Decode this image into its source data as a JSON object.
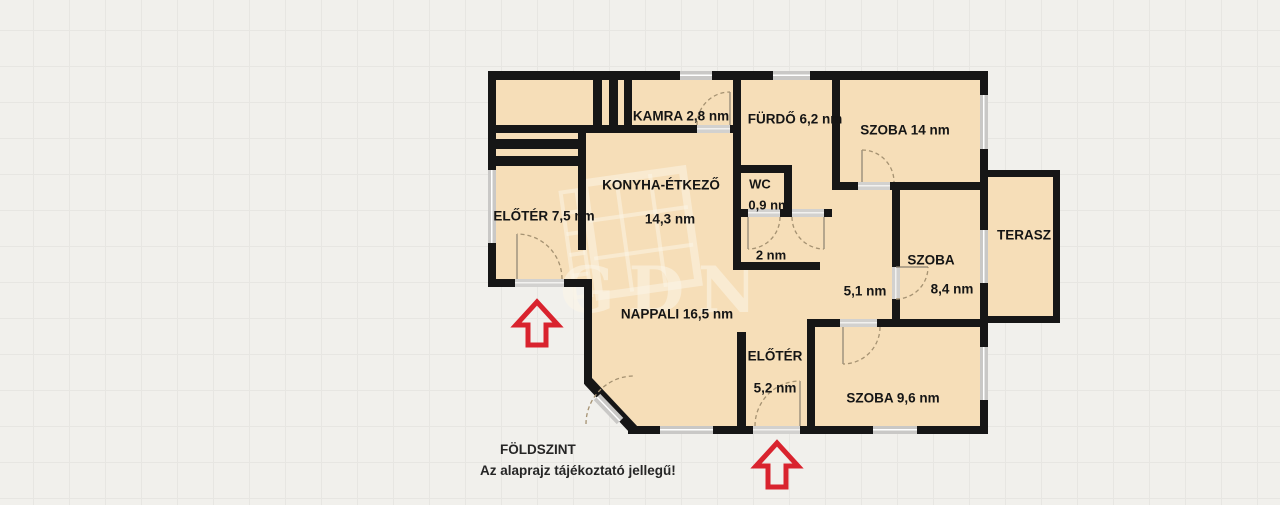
{
  "rooms": {
    "kamra": {
      "label": "KAMRA 2,8 nm"
    },
    "furdo": {
      "label": "FÜRDŐ 6,2 nm"
    },
    "szoba14": {
      "label": "SZOBA 14 nm"
    },
    "konyha": {
      "label": "KONYHA-ÉTKEZŐ",
      "area": "14,3 nm"
    },
    "wc": {
      "label": "WC",
      "area": "0,9 nm"
    },
    "eloter_felso": {
      "label": "ELŐTÉR 7,5 nm"
    },
    "kozlekedo_2": {
      "label": "2 nm"
    },
    "kozlekedo_51": {
      "label": "5,1 nm"
    },
    "szoba84": {
      "label": "SZOBA",
      "area": "8,4 nm"
    },
    "terasz": {
      "label": "TERASZ"
    },
    "nappali": {
      "label": "NAPPALI 16,5 nm"
    },
    "eloter_also": {
      "label": "ELŐTÉR",
      "area": "5,2 nm"
    },
    "szoba96": {
      "label": "SZOBA 9,6 nm"
    }
  },
  "footer": {
    "floor_label": "FÖLDSZINT",
    "disclaimer": "Az alaprajz tájékoztató jellegű!"
  },
  "watermark": {
    "text": "GDN"
  },
  "colors": {
    "bg": "#f1f0ec",
    "grid": "#e7e6e2",
    "room": "#f6deb8",
    "wall": "#161616",
    "window": "#c9c8c6",
    "red": "#d9232e"
  }
}
